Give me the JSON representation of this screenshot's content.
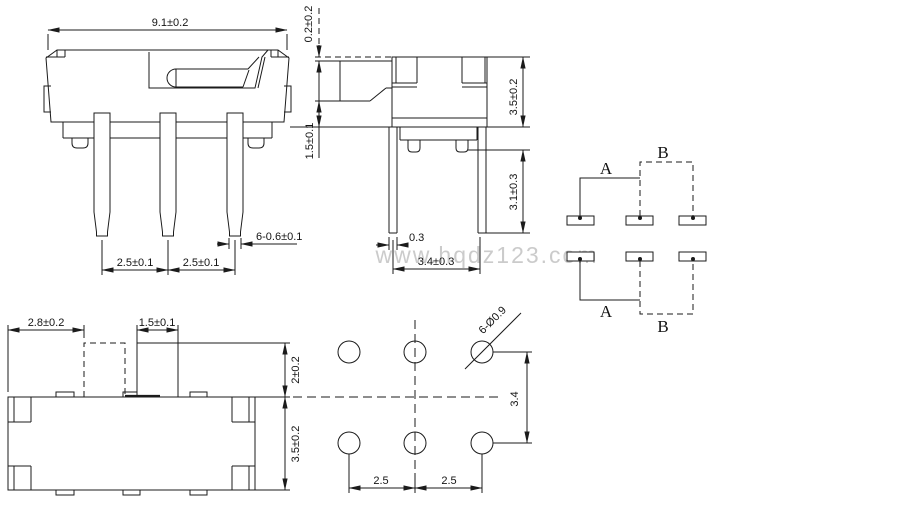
{
  "watermark": "www.hqdz123.com",
  "front_view": {
    "width_dim": "9.1±0.2",
    "pitch_dim_1": "2.5±0.1",
    "pitch_dim_2": "2.5±0.1",
    "pin_width_dim": "6-0.6±0.1"
  },
  "side_view": {
    "knob_travel_dim": "0.2±0.2",
    "seat_height_dim": "1.5±0.1",
    "body_height_dim": "3.5±0.2",
    "leg_length_dim": "3.1±0.3",
    "leg_thickness_dim": "0.3",
    "leg_span_dim": "3.4±0.3"
  },
  "circuit_diagram": {
    "position_a": "A",
    "position_b": "B"
  },
  "top_view": {
    "knob_offset_dim": "2.8±0.2",
    "knob_width_dim": "1.5±0.1",
    "knob_height_dim": "2±0.2",
    "body_depth_dim": "3.5±0.2"
  },
  "footprint": {
    "hole_dim": "6-Ø0.9",
    "row_pitch_dim": "3.4",
    "pitch_dim_1": "2.5",
    "pitch_dim_2": "2.5"
  },
  "colors": {
    "line": "#1b1b1b",
    "watermark": "#cbcbcb",
    "background": "#ffffff"
  }
}
